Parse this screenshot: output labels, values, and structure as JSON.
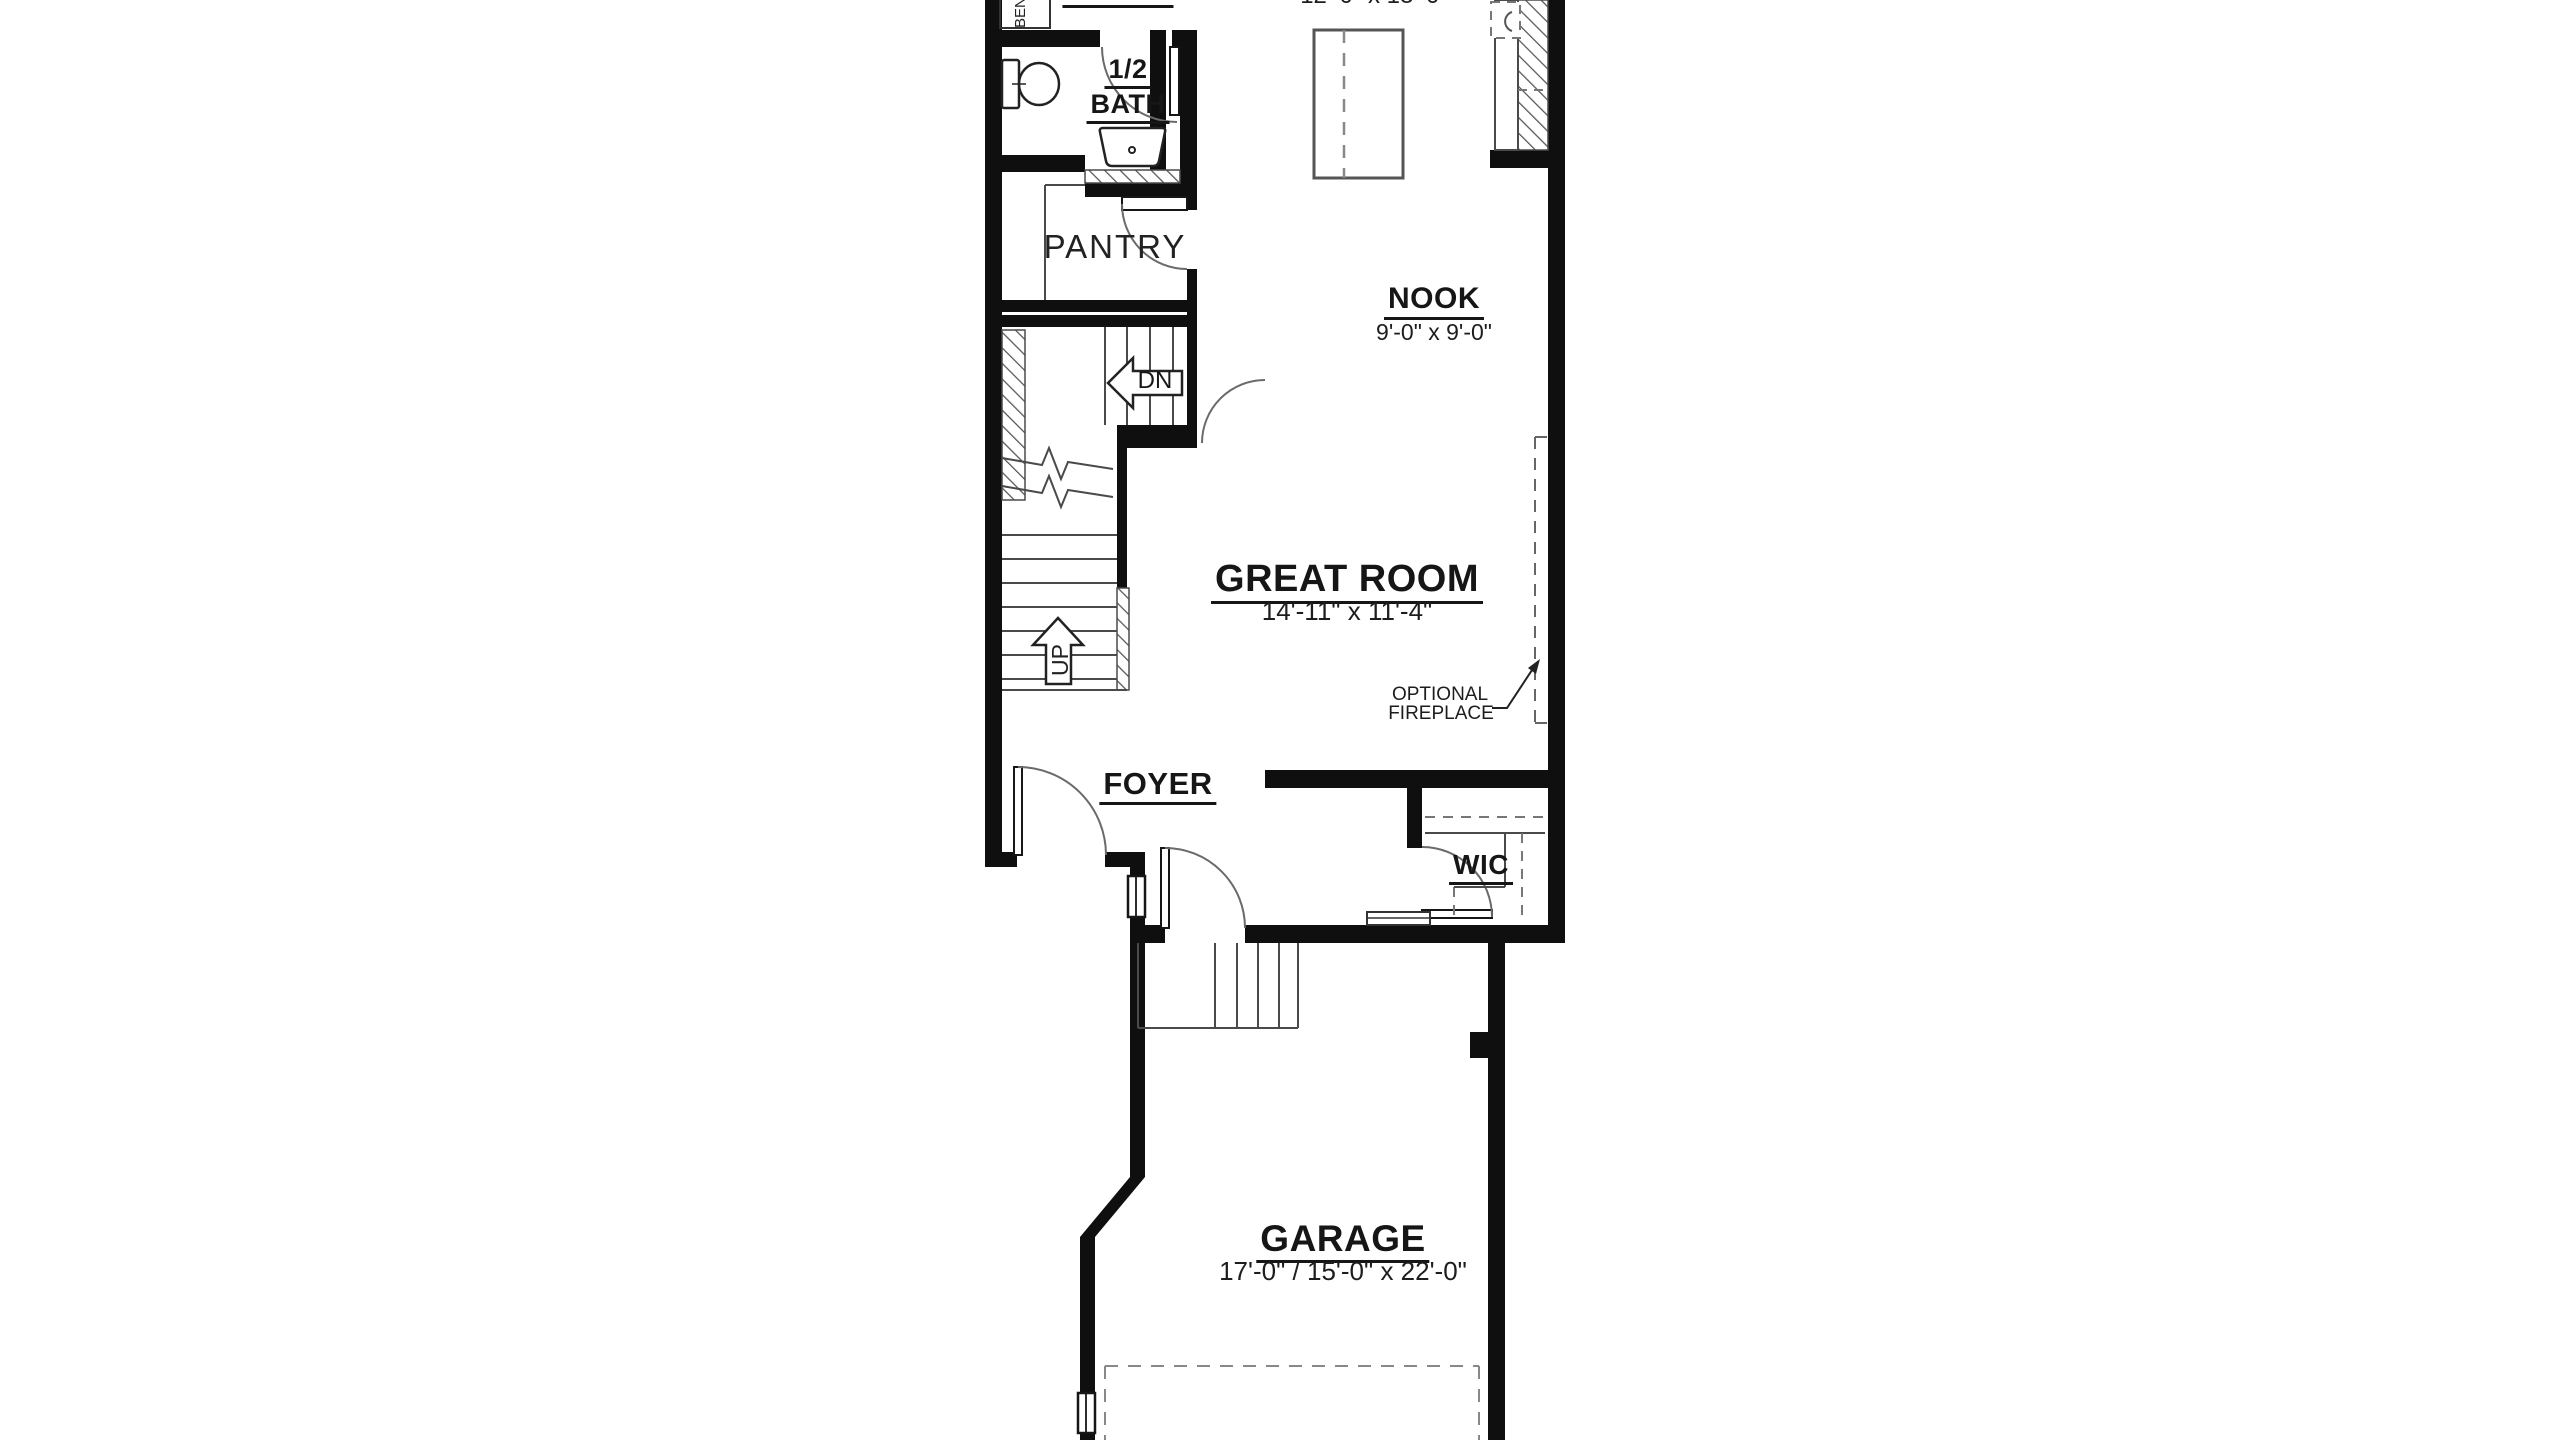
{
  "plan": {
    "rooms": {
      "entry": {
        "label": "ENTRY"
      },
      "bench": {
        "label": "BENCH"
      },
      "half_bath": {
        "label_line1": "1/2",
        "label_line2": "BATH"
      },
      "pantry": {
        "label": "PANTRY"
      },
      "kitchen": {
        "dimensions": "12'-0\" x 13'-0\""
      },
      "nook": {
        "label": "NOOK",
        "dimensions": "9'-0\" x 9'-0\""
      },
      "great_room": {
        "label": "GREAT ROOM",
        "dimensions": "14'-11\" x 11'-4\""
      },
      "foyer": {
        "label": "FOYER"
      },
      "wic": {
        "label": "WIC"
      },
      "garage": {
        "label": "GARAGE",
        "dimensions": "17'-0\" / 15'-0\" x 22'-0\""
      }
    },
    "annotations": {
      "optional_fireplace_line1": "OPTIONAL",
      "optional_fireplace_line2": "FIREPLACE",
      "stairs_down": "DN",
      "stairs_up": "UP"
    },
    "colors": {
      "wall": "#0f0f0f",
      "line": "#4a4a4a",
      "background": "#ffffff"
    }
  }
}
